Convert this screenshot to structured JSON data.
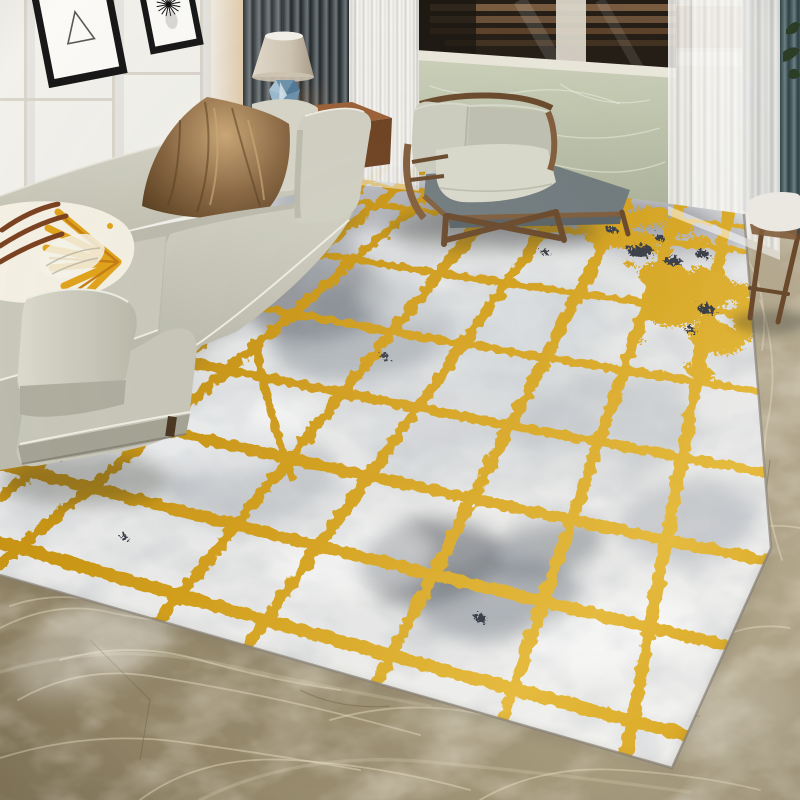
{
  "scene": {
    "alt": "Bright living room corner: beige fabric sofa with satin brown and yellow sunburst pillows, table lamp with faceted blue base, dark gray and white sheer curtains, balcony window with green marble half-wall, wooden armchair with sage cushions, and a large abstract area rug with irregular gold lattice lines over gray watercolor wash laid on brown marble flooring.",
    "objects": [
      "wall-panels",
      "picture-frame-triangle",
      "picture-frame-starburst",
      "dark-curtain",
      "sheer-curtain-left",
      "sheer-curtain-right",
      "teal-curtain",
      "balcony-window",
      "marble-half-wall",
      "table-lamp",
      "side-table",
      "white-cup",
      "sofa",
      "pillow-brown-satin",
      "pillow-beige",
      "pillow-yellow-sunburst",
      "coffee-table",
      "area-rug",
      "armchair",
      "stool-right",
      "plant-leaves",
      "marble-floor"
    ]
  },
  "colors": {
    "wallWhite": "#f2f1ec",
    "wallShadow": "#d7d3c9",
    "wallWarm": "#e3cdaf",
    "frameBlack": "#191919",
    "matWhite": "#fbfaf7",
    "artLine": "#5a5a5a",
    "curtainA": "#23282a",
    "curtainB": "#3f4649",
    "curtainC": "#5d6569",
    "curtainD": "#6d767a",
    "sheer1": "#fbfaf8",
    "sheer2": "#e6e4df",
    "sheer3": "#d6d4ce",
    "tealA": "#2f3e41",
    "tealB": "#4c6064",
    "tealC": "#6c8286",
    "glassDark": "#241e16",
    "deckWood": "#8a6748",
    "deckWoodDark": "#56402a",
    "postWhite": "#ddd8cb",
    "railWhite": "#ebe8dc",
    "marbleGreen": "#ccd1ba",
    "marbleGreenDark": "#aeb49b",
    "marbleVein": "#eef0e2",
    "chairWood": "#825e3c",
    "chairWoodDark": "#6b4a2c",
    "cushionSage": "#cdcec0",
    "cushionSageDark": "#c0c1b2",
    "cushionLight": "#dadacc",
    "seatGray": "#727c7f",
    "seatGrayDark": "#5a6366",
    "sofaBase": "#c7c6b7",
    "sofaLight": "#d8d7ca",
    "sofaMid": "#bdbcae",
    "sofaShadow": "#a5a495",
    "sofaPiping": "#f0efe5",
    "pillowBrown": "#8a6743",
    "pillowBrownLight": "#cba876",
    "pillowBrownDark": "#59401f",
    "pillowCream": "#d7d6c8",
    "yellowRay": "#e2a41c",
    "orangeRay": "#c77f15",
    "leafBrown": "#7c4322",
    "pillowWhite": "#f5f1e4",
    "rugWhite": "#f0f0ee",
    "rugGrayLight": "#c5cacf",
    "rugGray": "#8e949b",
    "rugDark": "#3f464e",
    "rugDarkSpeck": "#3b4049",
    "gold": "#d4a01c",
    "goldLight": "#e8bd3f",
    "goldDark": "#b8860f",
    "floorA": "#877a5d",
    "floorB": "#a89c7f",
    "floorC": "#b7ac92",
    "floorVein": "#e8e0c6",
    "floorCrack": "#6b5f47",
    "woodDark": "#38261602",
    "woodBody": "#4a2f1a",
    "woodDarkest": "#2a180b",
    "woodTopLight": "#a8764a",
    "tableWood": "#9c6136",
    "tableWoodDark": "#6f4323",
    "lampShadeL": "#e6ddcf",
    "lampShadeR": "#a39681",
    "lampRim": "#f4f1ea",
    "lampBlue1": "#a9c4d6",
    "lampBlue2": "#6f93ad",
    "lampBlue3": "#527a97",
    "lampBlue4": "#d8e6ee",
    "plantGreen": "#2c3d26",
    "shadow": "#2f332c",
    "cupWhite": "#f2efe8"
  },
  "rug": {
    "gold_lines": [
      {
        "d": "M298,193 Q545,230 792,256",
        "w": 6
      },
      {
        "d": "M238,241 Q515,287 792,322",
        "w": 7
      },
      {
        "d": "M148,287 Q470,348 792,396",
        "w": 8
      },
      {
        "d": "M58,335 Q425,412 792,477",
        "w": 9.5
      },
      {
        "d": "M0,392 Q396,485 792,566",
        "w": 11
      },
      {
        "d": "M0,464 Q396,568 792,661",
        "w": 12
      },
      {
        "d": "M0,542 Q390,660 780,759",
        "w": 13
      },
      {
        "d": "M0,617 Q280,720 560,812",
        "w": 13
      },
      {
        "d": "M242,168 Q120,232 0,295",
        "w": 7
      },
      {
        "d": "M308,168 Q155,262 0,352",
        "w": 8
      },
      {
        "d": "M385,168 Q195,308 0,442",
        "w": 9
      },
      {
        "d": "M420,170 Q210,336 0,497",
        "w": 9.5
      },
      {
        "d": "M456,170 Q230,370 0,564",
        "w": 10
      },
      {
        "d": "M522,172 Q290,458 60,742",
        "w": 11
      },
      {
        "d": "M583,176 Q360,490 136,802",
        "w": 11
      },
      {
        "d": "M638,180 Q476,492 315,802",
        "w": 12
      },
      {
        "d": "M688,184 Q580,494 475,802",
        "w": 12
      },
      {
        "d": "M733,188 Q674,496 617,802",
        "w": 12.5
      },
      {
        "d": "M336,180 Q540,208 745,227",
        "w": 4.5
      },
      {
        "d": "M255,342 Q268,412 292,478",
        "w": 8
      }
    ],
    "splatter": [
      [
        562,
        214,
        26,
        11,
        -6,
        "g"
      ],
      [
        604,
        221,
        32,
        13,
        4,
        "g"
      ],
      [
        648,
        217,
        22,
        10,
        -12,
        "g"
      ],
      [
        678,
        228,
        16,
        8,
        2,
        "g"
      ],
      [
        622,
        239,
        38,
        9,
        3,
        "g"
      ],
      [
        590,
        205,
        14,
        6,
        0,
        "g"
      ],
      [
        700,
        242,
        12,
        6,
        0,
        "g"
      ],
      [
        688,
        298,
        46,
        26,
        -18,
        "g"
      ],
      [
        716,
        338,
        28,
        16,
        12,
        "g"
      ],
      [
        662,
        274,
        24,
        13,
        -4,
        "g"
      ],
      [
        736,
        292,
        18,
        9,
        0,
        "g"
      ],
      [
        700,
        372,
        16,
        8,
        20,
        "g"
      ],
      [
        745,
        320,
        12,
        22,
        -4,
        "g"
      ],
      [
        540,
        228,
        6,
        4,
        0,
        "g"
      ],
      [
        520,
        214,
        5,
        3,
        0,
        "g"
      ],
      [
        656,
        250,
        7,
        4,
        0,
        "g"
      ],
      [
        630,
        264,
        6,
        3,
        0,
        "g"
      ],
      [
        700,
        270,
        8,
        4,
        0,
        "g"
      ],
      [
        670,
        320,
        7,
        4,
        0,
        "g"
      ],
      [
        640,
        340,
        5,
        3,
        0,
        "g"
      ],
      [
        720,
        260,
        6,
        3,
        0,
        "g"
      ],
      [
        640,
        251,
        13,
        6,
        -5,
        "d"
      ],
      [
        673,
        261,
        9,
        4,
        0,
        "d"
      ],
      [
        702,
        254,
        7,
        4,
        0,
        "d"
      ],
      [
        573,
        206,
        9,
        4,
        0,
        "d"
      ],
      [
        706,
        309,
        8,
        5,
        0,
        "d"
      ],
      [
        612,
        230,
        6,
        3,
        0,
        "d"
      ],
      [
        660,
        238,
        5,
        3,
        0,
        "d"
      ],
      [
        480,
        618,
        6,
        4,
        0,
        "d"
      ],
      [
        124,
        537,
        4,
        3,
        0,
        "d"
      ],
      [
        384,
        356,
        5,
        3,
        0,
        "d"
      ],
      [
        545,
        252,
        5,
        3,
        0,
        "d"
      ],
      [
        690,
        330,
        6,
        3,
        0,
        "d"
      ]
    ],
    "blotches": [
      [
        320,
        300,
        72,
        40,
        "#4a5058",
        0.5,
        -10
      ],
      [
        362,
        332,
        92,
        48,
        "#78808a",
        0.45,
        -8
      ],
      [
        298,
        252,
        60,
        30,
        "#9aa0a8",
        0.55,
        -5
      ],
      [
        420,
        206,
        150,
        26,
        "#8e8f98",
        0.5,
        2
      ],
      [
        560,
        210,
        150,
        24,
        "#858692",
        0.45,
        3
      ],
      [
        650,
        228,
        110,
        26,
        "#7b7c86",
        0.4,
        4
      ],
      [
        430,
        560,
        70,
        44,
        "#3f464e",
        0.5,
        -12
      ],
      [
        498,
        600,
        84,
        40,
        "#6d747e",
        0.45,
        -6
      ],
      [
        545,
        548,
        60,
        30,
        "#59606a",
        0.4,
        -15
      ],
      [
        250,
        478,
        85,
        48,
        "#aeb4ba",
        0.5,
        -8
      ],
      [
        600,
        430,
        95,
        58,
        "#b6bcc2",
        0.45,
        -10
      ],
      [
        688,
        520,
        70,
        40,
        "#9aa1a9",
        0.4,
        -8
      ],
      [
        180,
        430,
        70,
        36,
        "#c2c7cc",
        0.5,
        -6
      ],
      [
        520,
        330,
        90,
        50,
        "#cdd2d6",
        0.45,
        -8
      ],
      [
        470,
        430,
        110,
        60,
        "#c5cacf",
        0.4,
        -8
      ],
      [
        225,
        432,
        90,
        40,
        "#ffffff",
        0.55,
        -8
      ],
      [
        525,
        485,
        100,
        42,
        "#f4f4f2",
        0.5,
        -8
      ],
      [
        610,
        635,
        90,
        36,
        "#ffffff",
        0.5,
        -10
      ],
      [
        350,
        560,
        80,
        34,
        "#ffffff",
        0.45,
        -8
      ],
      [
        430,
        290,
        70,
        30,
        "#e8e9e9",
        0.5,
        -6
      ]
    ]
  },
  "floor": {
    "veins": [
      "M0,628 Q55,600 108,612 T215,622 T320,655",
      "M18,700 Q80,665 150,676 T280,700 T420,735",
      "M0,758 Q90,730 180,742 T360,770",
      "M140,800 Q200,755 290,760 T470,790",
      "M330,720 Q400,700 470,712 T610,740",
      "M480,800 Q540,765 620,770 T760,790",
      "M700,650 Q740,620 790,628",
      "M720,540 Q760,520 800,528",
      "M760,300 Q780,360 768,420 T782,560",
      "M748,260 Q770,300 762,350",
      "M10,606 Q50,592 95,600",
      "M60,660 Q130,640 200,660 T340,690"
    ],
    "wide_veins": [
      "M0,672 Q110,640 220,664 T430,706",
      "M200,800 Q300,750 430,762 T690,792"
    ],
    "cracks": [
      "M90,640 L150,700 L140,760",
      "M600,700 Q650,720 700,716",
      "M300,690 Q340,710 390,706",
      "M770,460 L760,540"
    ]
  },
  "window_wall": {
    "veins": [
      "M430,86 Q470,100 520,92 T620,104",
      "M420,130 Q480,118 540,132 T660,128",
      "M450,168 Q500,152 560,166 T665,162",
      "M560,84 Q600,110 650,100",
      "M425,105 Q445,125 440,150"
    ]
  }
}
